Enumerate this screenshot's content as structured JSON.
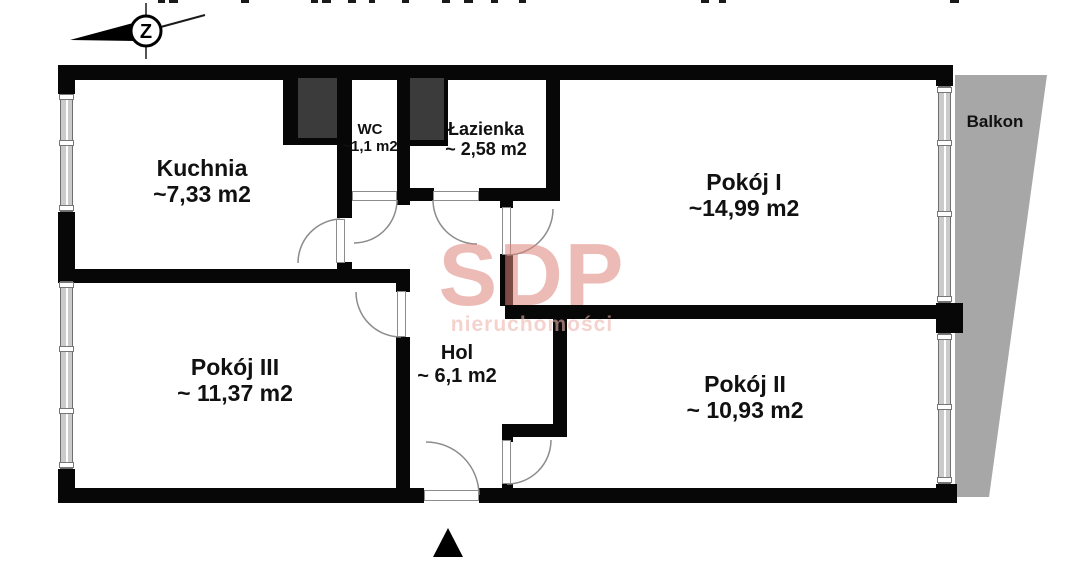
{
  "watermark": {
    "brand": "SDP",
    "tagline": "nieruchomości"
  },
  "compass": {
    "letter": "Z"
  },
  "rooms": [
    {
      "name": "Kuchnia",
      "area": "~7,33 m2"
    },
    {
      "name": "WC",
      "area": "~1,1 m2"
    },
    {
      "name": "Łazienka",
      "area": "~ 2,58 m2"
    },
    {
      "name": "Pokój I",
      "area": "~14,99 m2"
    },
    {
      "name": "Pokój III",
      "area": "~ 11,37 m2"
    },
    {
      "name": "Hol",
      "area": "~ 6,1 m2"
    },
    {
      "name": "Pokój II",
      "area": "~ 10,93 m2"
    },
    {
      "name": "Balkon",
      "area": ""
    }
  ]
}
